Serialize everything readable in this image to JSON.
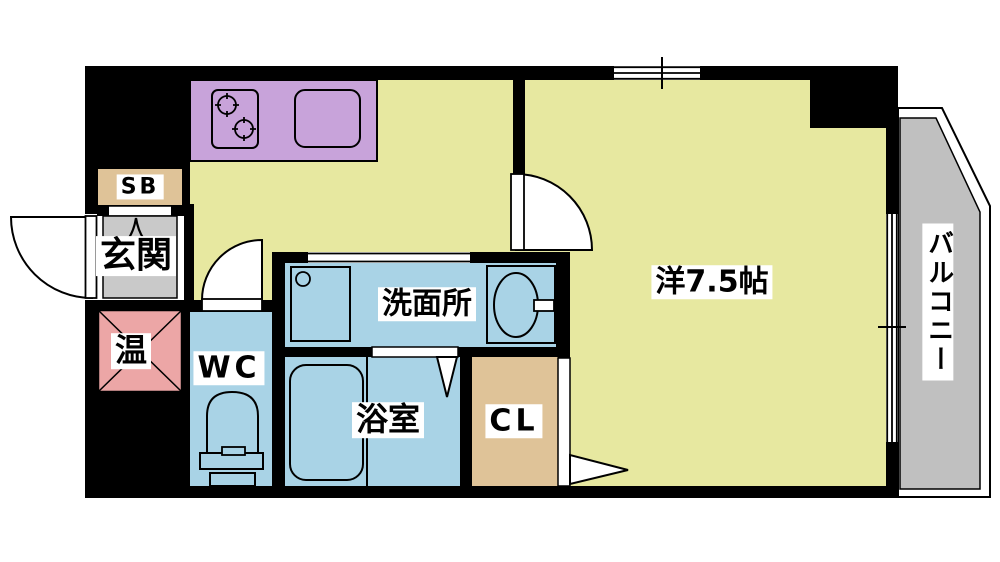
{
  "plan": {
    "type": "apartment-floor-plan",
    "rooms": {
      "entrance": "玄関",
      "shoe_box": "SB",
      "water_heater": "温",
      "wc": "WC",
      "washroom": "洗面所",
      "bathroom": "浴室",
      "closet": "CL",
      "main_room": "洋7.5帖",
      "balcony": "バルコニー"
    },
    "main_room_size_tatami": 7.5,
    "fixtures": {
      "stove": "gas-stove-2-burner-icon",
      "kitchen_sink": "kitchen-sink-icon",
      "washing_machine": "washing-machine-pan-icon",
      "washbasin": "washbasin-icon",
      "bathtub": "bathtub-icon",
      "toilet": "toilet-icon",
      "entrance_mark": "entrance-arch-icon"
    },
    "openings": [
      "entrance-swing-door",
      "kitchen-swing-door",
      "wc-swing-door",
      "washroom-sliding-opening",
      "bathroom-folding-door",
      "closet-folding-door",
      "top-window",
      "balcony-window"
    ]
  },
  "colors": {
    "room-yellow": "#E7E8A0",
    "counter-purple": "#C8A3DA",
    "wet-blue": "#A9D3E6",
    "storage-tan": "#DFC398",
    "heater-pink": "#ECA6A6",
    "entrance-grey": "#C9C9C9",
    "balcony-grey": "#C0C0C0",
    "wall-black": "#000000"
  }
}
